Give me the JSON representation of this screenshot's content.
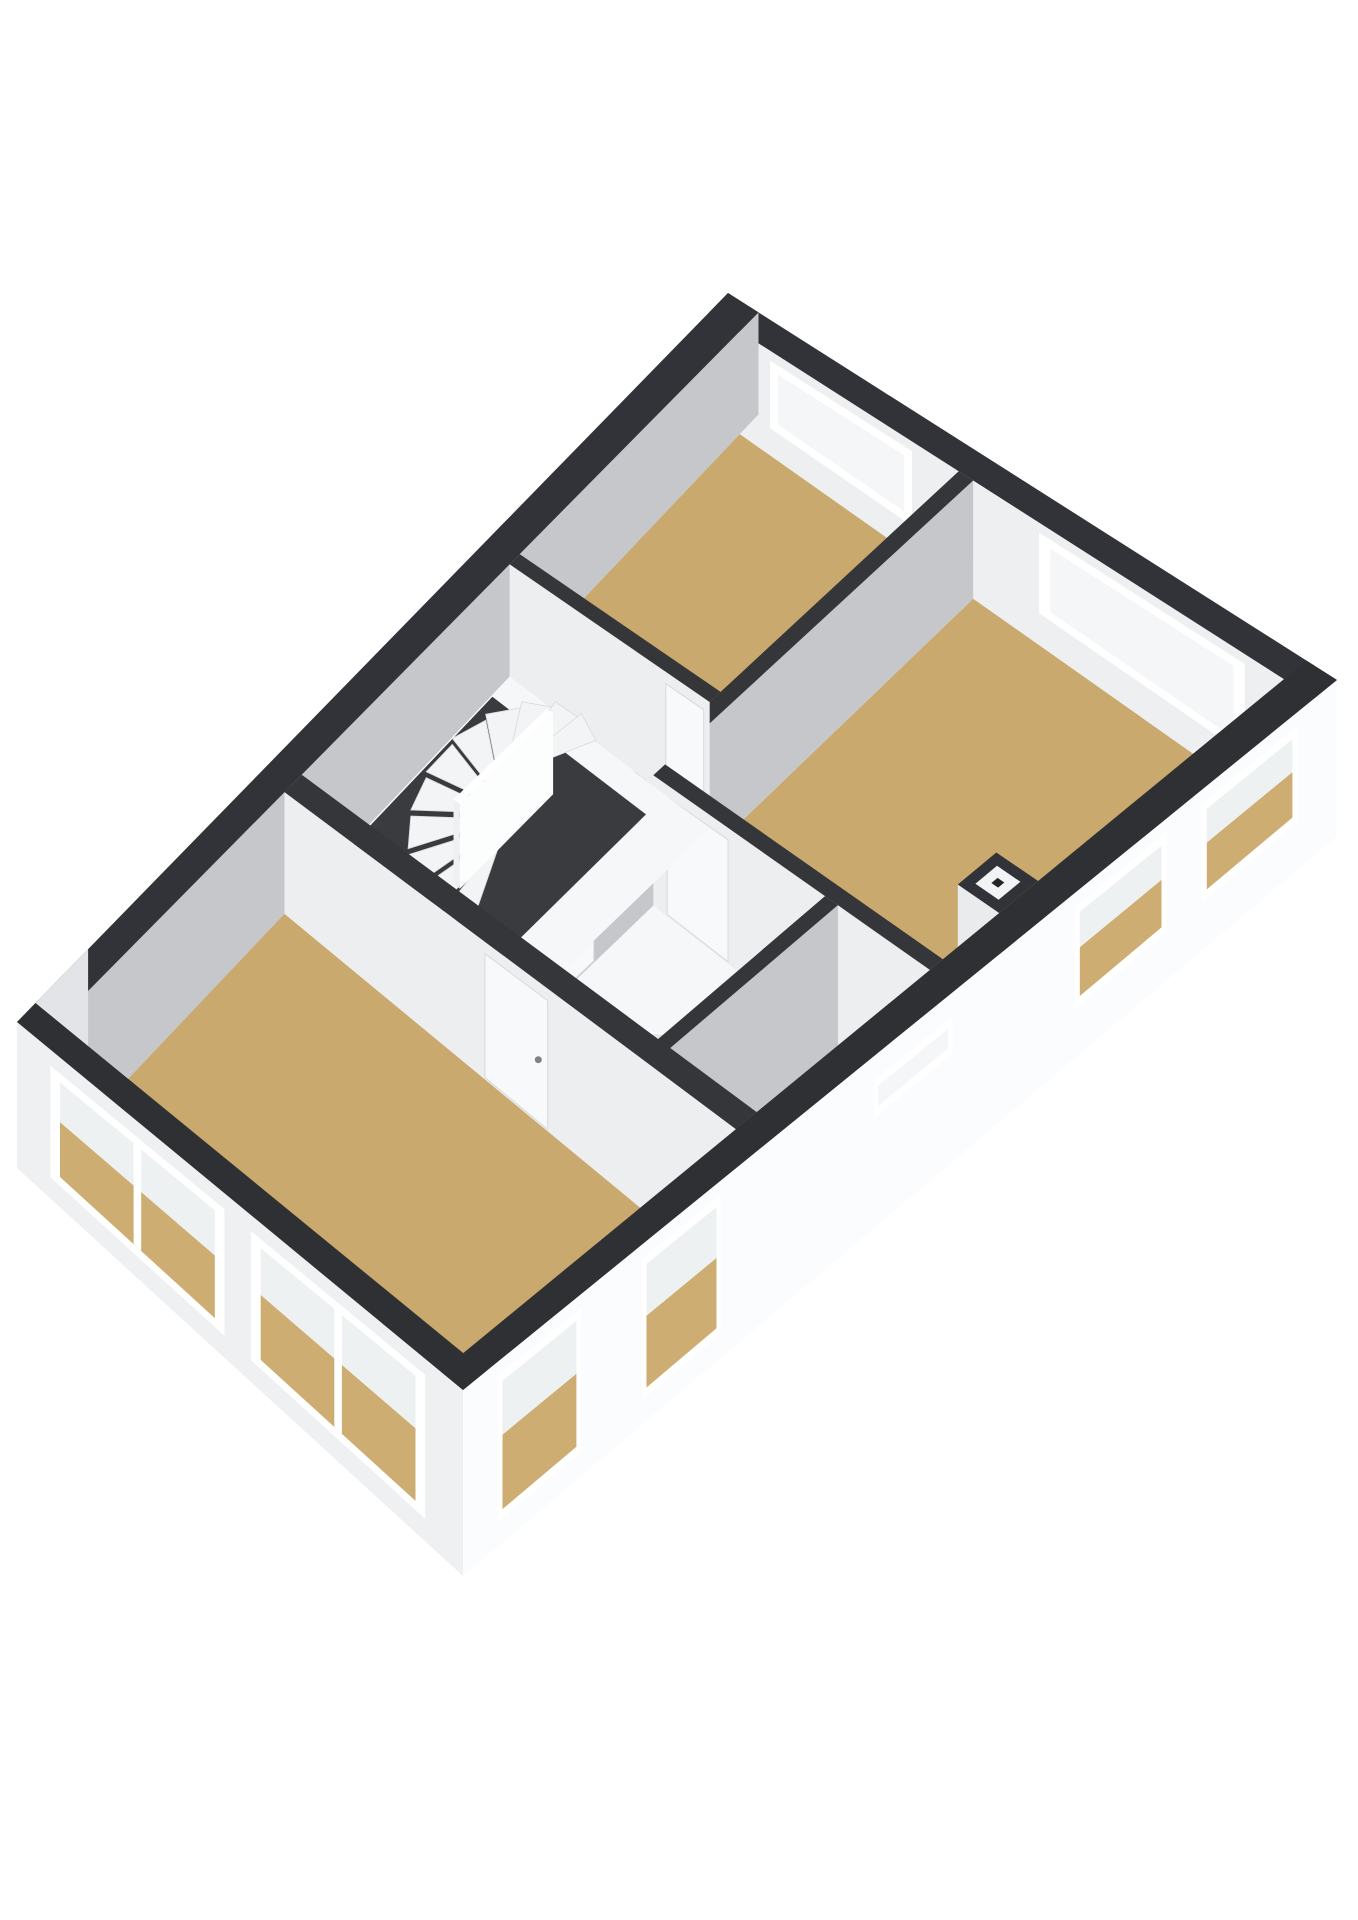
{
  "scene": {
    "description": "3D isometric floor plan render of an upper storey with three tan-floored bedrooms, central winder staircase, landing, bathroom with corner shower, hallway, chimney flue and white exterior walls with dark cut-wall caps",
    "background": "#ffffff",
    "width": 1358,
    "height": 1920
  },
  "colors": {
    "wall_cap_dark": "#313338",
    "wall_cap_interior": "#34363a",
    "inner_face_gray": "#c5c7cb",
    "inner_face_light": "#eceef0",
    "floor_tan": "#c9a96d",
    "floor_white": "#f6f7f8",
    "stair_well_dark": "#3a3b3f",
    "step_white": "#f3f4f6",
    "exterior_white": "#fbfcfd",
    "window_frame": "#ffffff",
    "pane_upper": "#eef1f2",
    "pane_tan": "#cdad72"
  },
  "projection": {
    "corners": {
      "n": [
        728,
        293
      ],
      "e": [
        1337,
        680
      ],
      "w": [
        17,
        1022
      ],
      "s": [
        463,
        1390
      ]
    },
    "height": [
      100,
      40,
      30
    ]
  },
  "rooms": [
    {
      "name": "bedroom-1",
      "floor": "tan"
    },
    {
      "name": "bedroom-2",
      "floor": "tan"
    },
    {
      "name": "landing-with-stairs",
      "floor": "white"
    },
    {
      "name": "bathroom-with-shower",
      "floor": "white"
    },
    {
      "name": "hallway",
      "floor": "white"
    },
    {
      "name": "master-bedroom",
      "floor": "tan"
    }
  ],
  "shapes": [
    {
      "n": "ne-wall-inner-face",
      "t": "face",
      "line": [
        [
          0,
          0.026
        ],
        [
          1,
          0.026
        ]
      ],
      "fill": "#edeff1"
    },
    {
      "n": "window-bed1-ne",
      "t": "window",
      "line": [
        [
          0,
          0.026
        ],
        [
          1,
          0.026
        ]
      ],
      "t0": 0.1,
      "t1": 0.335,
      "top": 10,
      "botFrac": 0.74,
      "pane": "pale"
    },
    {
      "n": "window-bed2-ne",
      "t": "window",
      "line": [
        [
          0,
          0.026
        ],
        [
          1,
          0.026
        ]
      ],
      "t0": 0.545,
      "t1": 0.885,
      "top": 10,
      "botFrac": 0.74,
      "pane": "pale"
    },
    {
      "n": "ne-wall-cap",
      "t": "cap",
      "rect": [
        0,
        1,
        0,
        0.026
      ],
      "fill": "#313338"
    },
    {
      "n": "nw-wall-inner-face",
      "t": "face",
      "line": [
        [
          0.05,
          0
        ],
        [
          0.05,
          1
        ]
      ],
      "fill": "#c5c7cb"
    },
    {
      "n": "nw-wall-cap",
      "t": "cap",
      "rect": [
        0,
        0.05,
        0,
        1
      ],
      "fill": "#313338"
    },
    {
      "n": "bed1-floor",
      "t": "floor",
      "rect": [
        0.05,
        0.412,
        0.026,
        0.332
      ],
      "fill": "#c9a96d"
    },
    {
      "n": "bed2-floor",
      "t": "floor",
      "rect": [
        0.436,
        0.95,
        0.026,
        0.42
      ],
      "fill": "#c9a96d"
    },
    {
      "n": "window-reveal-se-1",
      "t": "face",
      "line": [
        [
          0.945,
          0.045
        ],
        [
          0.945,
          0.155
        ]
      ],
      "top": 6,
      "botFrac": 0.5,
      "fill": "#f3f5f6"
    },
    {
      "n": "window-reveal-se-2",
      "t": "face",
      "line": [
        [
          0.945,
          0.195
        ],
        [
          0.945,
          0.3
        ]
      ],
      "top": 6,
      "botFrac": 0.5,
      "fill": "#f3f5f6"
    },
    {
      "n": "divider-wall-face",
      "t": "face",
      "line": [
        [
          0.436,
          0.026
        ],
        [
          0.436,
          0.648
        ]
      ],
      "fill": "#c5c7cb"
    },
    {
      "n": "bathroom-door",
      "t": "door",
      "line": [
        [
          0.436,
          0.026
        ],
        [
          0.436,
          0.648
        ]
      ],
      "t0": 0.78,
      "t1": 0.945,
      "top": 12
    },
    {
      "n": "divider-wall-cap",
      "t": "cap",
      "rect": [
        0.412,
        0.436,
        0.026,
        0.648
      ],
      "fill": "#34363a"
    },
    {
      "n": "bed1-back-wall-face",
      "t": "face",
      "line": [
        [
          0.05,
          0.346
        ],
        [
          0.412,
          0.346
        ]
      ],
      "fill": "#eceef0"
    },
    {
      "n": "door-bed1",
      "t": "door",
      "line": [
        [
          0.05,
          0.346
        ],
        [
          0.412,
          0.346
        ]
      ],
      "t0": 0.78,
      "t1": 0.97,
      "top": 12
    },
    {
      "n": "bed1-back-wall-cap",
      "t": "cap",
      "rect": [
        0.05,
        0.412,
        0.332,
        0.346
      ],
      "fill": "#34363a"
    },
    {
      "n": "bed2-back-wall-face",
      "t": "face",
      "line": [
        [
          0.436,
          0.435
        ],
        [
          0.95,
          0.435
        ]
      ],
      "fill": "#eceef0"
    },
    {
      "n": "door-bed2",
      "t": "door",
      "line": [
        [
          0.436,
          0.435
        ],
        [
          0.95,
          0.435
        ]
      ],
      "t0": 0.05,
      "t1": 0.27,
      "top": 12
    },
    {
      "n": "bed2-back-wall-cap",
      "t": "cap",
      "rect": [
        0.436,
        0.95,
        0.42,
        0.435
      ],
      "fill": "#34363a"
    },
    {
      "n": "chimney-face",
      "t": "face",
      "line": [
        [
          0.875,
          0.355
        ],
        [
          0.95,
          0.355
        ]
      ],
      "fill": "#e9ebed"
    },
    {
      "n": "chimney-cap",
      "t": "cap",
      "rect": [
        0.875,
        0.95,
        0.31,
        0.355
      ],
      "fill": "#313338"
    },
    {
      "n": "chimney-flue-rim",
      "t": "capinset",
      "rect": [
        0.875,
        0.95,
        0.31,
        0.355
      ],
      "inset": 0.22,
      "fill": "#f2f3f4"
    },
    {
      "n": "chimney-flue-hole",
      "t": "capinset",
      "rect": [
        0.875,
        0.95,
        0.31,
        0.355
      ],
      "inset": 0.42,
      "fill": "#232427"
    },
    {
      "n": "landing-floor",
      "t": "floor",
      "rect": [
        0.05,
        0.412,
        0.346,
        0.635
      ],
      "fill": "#f6f7f8"
    },
    {
      "n": "stairwell-opening",
      "t": "floor",
      "rect": [
        0.05,
        0.33,
        0.37,
        0.62
      ],
      "fill": "#3a3b3f",
      "dy": 2
    },
    {
      "n": "stairs-winder",
      "t": "steps",
      "cx": 0.21,
      "cy": 0.475,
      "ra": 0.12,
      "rb": 0.095,
      "a0": 60,
      "a1": 300,
      "num": 11
    },
    {
      "n": "stair-newel-face-a",
      "t": "face",
      "line": [
        [
          0.215,
          0.41
        ],
        [
          0.215,
          0.535
        ]
      ],
      "top": 40,
      "fill": "#fcfdfd"
    },
    {
      "n": "stair-newel-face-b",
      "t": "face",
      "line": [
        [
          0.203,
          0.535
        ],
        [
          0.215,
          0.535
        ]
      ],
      "top": 40,
      "fill": "#eef0f2"
    },
    {
      "n": "stair-newel-cap",
      "t": "cap",
      "rect": [
        0.203,
        0.215,
        0.41,
        0.535
      ],
      "dy": 40,
      "fill": "#ffffff"
    },
    {
      "n": "bathroom-floor",
      "t": "floor",
      "rect": [
        0.436,
        0.755,
        0.435,
        0.635
      ],
      "fill": "#f6f7f8"
    },
    {
      "n": "shower-corner",
      "t": "shower",
      "cx": 0.742,
      "cy": 0.622,
      "ra": 0.145,
      "rb": 0.075,
      "a0": 180,
      "a1": 270
    },
    {
      "n": "bathroom-east-wall-face",
      "t": "face",
      "line": [
        [
          0.779,
          0.435
        ],
        [
          0.779,
          0.648
        ]
      ],
      "fill": "#c5c7cb"
    },
    {
      "n": "bathroom-east-wall-cap",
      "t": "cap",
      "rect": [
        0.755,
        0.779,
        0.435,
        0.648
      ],
      "fill": "#34363a"
    },
    {
      "n": "hall-floor",
      "t": "floor",
      "rect": [
        0.779,
        0.95,
        0.435,
        0.635
      ],
      "fill": "#f6f7f8"
    },
    {
      "n": "window-reveal-se-slit",
      "t": "face",
      "line": [
        [
          0.945,
          0.44
        ],
        [
          0.945,
          0.53
        ]
      ],
      "top": 8,
      "botFrac": 0.32,
      "fill": "#f3f5f6"
    },
    {
      "n": "master-wall-face",
      "t": "face",
      "line": [
        [
          0.05,
          0.659
        ],
        [
          0.95,
          0.659
        ]
      ],
      "fill": "#eceef0"
    },
    {
      "n": "door-master",
      "t": "door",
      "line": [
        [
          0.05,
          0.659
        ],
        [
          0.95,
          0.659
        ]
      ],
      "t0": 0.444,
      "t1": 0.583,
      "top": 12,
      "handle": 1
    },
    {
      "n": "master-wall-cap",
      "t": "cap",
      "rect": [
        0.05,
        0.95,
        0.635,
        0.659
      ],
      "fill": "#34363a"
    },
    {
      "n": "master-floor",
      "t": "floor",
      "rect": [
        0.05,
        0.95,
        0.659,
        0.974
      ],
      "fill": "#c9a96d"
    },
    {
      "n": "window-reveal-se-3",
      "t": "face",
      "line": [
        [
          0.945,
          0.705
        ],
        [
          0.945,
          0.795
        ]
      ],
      "top": 6,
      "botFrac": 0.6,
      "fill": "#f3f5f6"
    },
    {
      "n": "window-reveal-se-4",
      "t": "face",
      "line": [
        [
          0.945,
          0.865
        ],
        [
          0.945,
          0.96
        ]
      ],
      "top": 6,
      "botFrac": 0.6,
      "fill": "#f3f5f6"
    },
    {
      "n": "nw-facade-corner",
      "t": "face",
      "line": [
        [
          0,
          0.9
        ],
        [
          0,
          1
        ]
      ],
      "botExtra": 16,
      "fill": "#e3e4e7"
    },
    {
      "n": "se-facade",
      "t": "face",
      "line": [
        [
          1,
          0
        ],
        [
          1,
          1
        ]
      ],
      "botExtra": 16,
      "fill": "#fbfcfd"
    },
    {
      "n": "window-bed2-se-1",
      "t": "window",
      "line": [
        [
          1,
          0
        ],
        [
          1,
          1
        ]
      ],
      "t0": 0.045,
      "t1": 0.155,
      "top": 14,
      "botFrac": 0.78,
      "pane": "tall"
    },
    {
      "n": "window-bed2-se-2",
      "t": "window",
      "line": [
        [
          1,
          0
        ],
        [
          1,
          1
        ]
      ],
      "t0": 0.195,
      "t1": 0.3,
      "top": 14,
      "botFrac": 0.78,
      "pane": "tall"
    },
    {
      "n": "window-hall-slit",
      "t": "window",
      "line": [
        [
          1,
          0
        ],
        [
          1,
          1
        ]
      ],
      "t0": 0.44,
      "t1": 0.53,
      "top": 24,
      "botFrac": 0.4,
      "pane": "pale"
    },
    {
      "n": "window-master-se-1",
      "t": "window",
      "line": [
        [
          1,
          0
        ],
        [
          1,
          1
        ]
      ],
      "t0": 0.705,
      "t1": 0.795,
      "top": 14,
      "botFrac": 0.95,
      "pane": "tall"
    },
    {
      "n": "window-master-se-2",
      "t": "window",
      "line": [
        [
          1,
          0
        ],
        [
          1,
          1
        ]
      ],
      "t0": 0.865,
      "t1": 0.96,
      "top": 14,
      "botFrac": 0.95,
      "pane": "tall"
    },
    {
      "n": "se-wall-cap",
      "t": "cap",
      "rect": [
        0.95,
        1,
        0,
        1
      ],
      "fill": "#2e3033"
    },
    {
      "n": "sw-facade",
      "t": "face",
      "line": [
        [
          0,
          1
        ],
        [
          1,
          1
        ]
      ],
      "botExtra": 16,
      "fill": "#eff0f2"
    },
    {
      "n": "window-master-sw-1",
      "t": "window",
      "line": [
        [
          0,
          1
        ],
        [
          1,
          1
        ]
      ],
      "t0": 0.075,
      "t1": 0.465,
      "top": 16,
      "botFrac": 0.96,
      "pane": "tall",
      "mullion": 1
    },
    {
      "n": "window-master-sw-2",
      "t": "window",
      "line": [
        [
          0,
          1
        ],
        [
          1,
          1
        ]
      ],
      "t0": 0.525,
      "t1": 0.915,
      "top": 16,
      "botFrac": 0.96,
      "pane": "tall",
      "mullion": 1
    },
    {
      "n": "sw-wall-cap",
      "t": "cap",
      "rect": [
        0,
        1,
        0.974,
        1
      ],
      "fill": "#2e3033"
    }
  ]
}
